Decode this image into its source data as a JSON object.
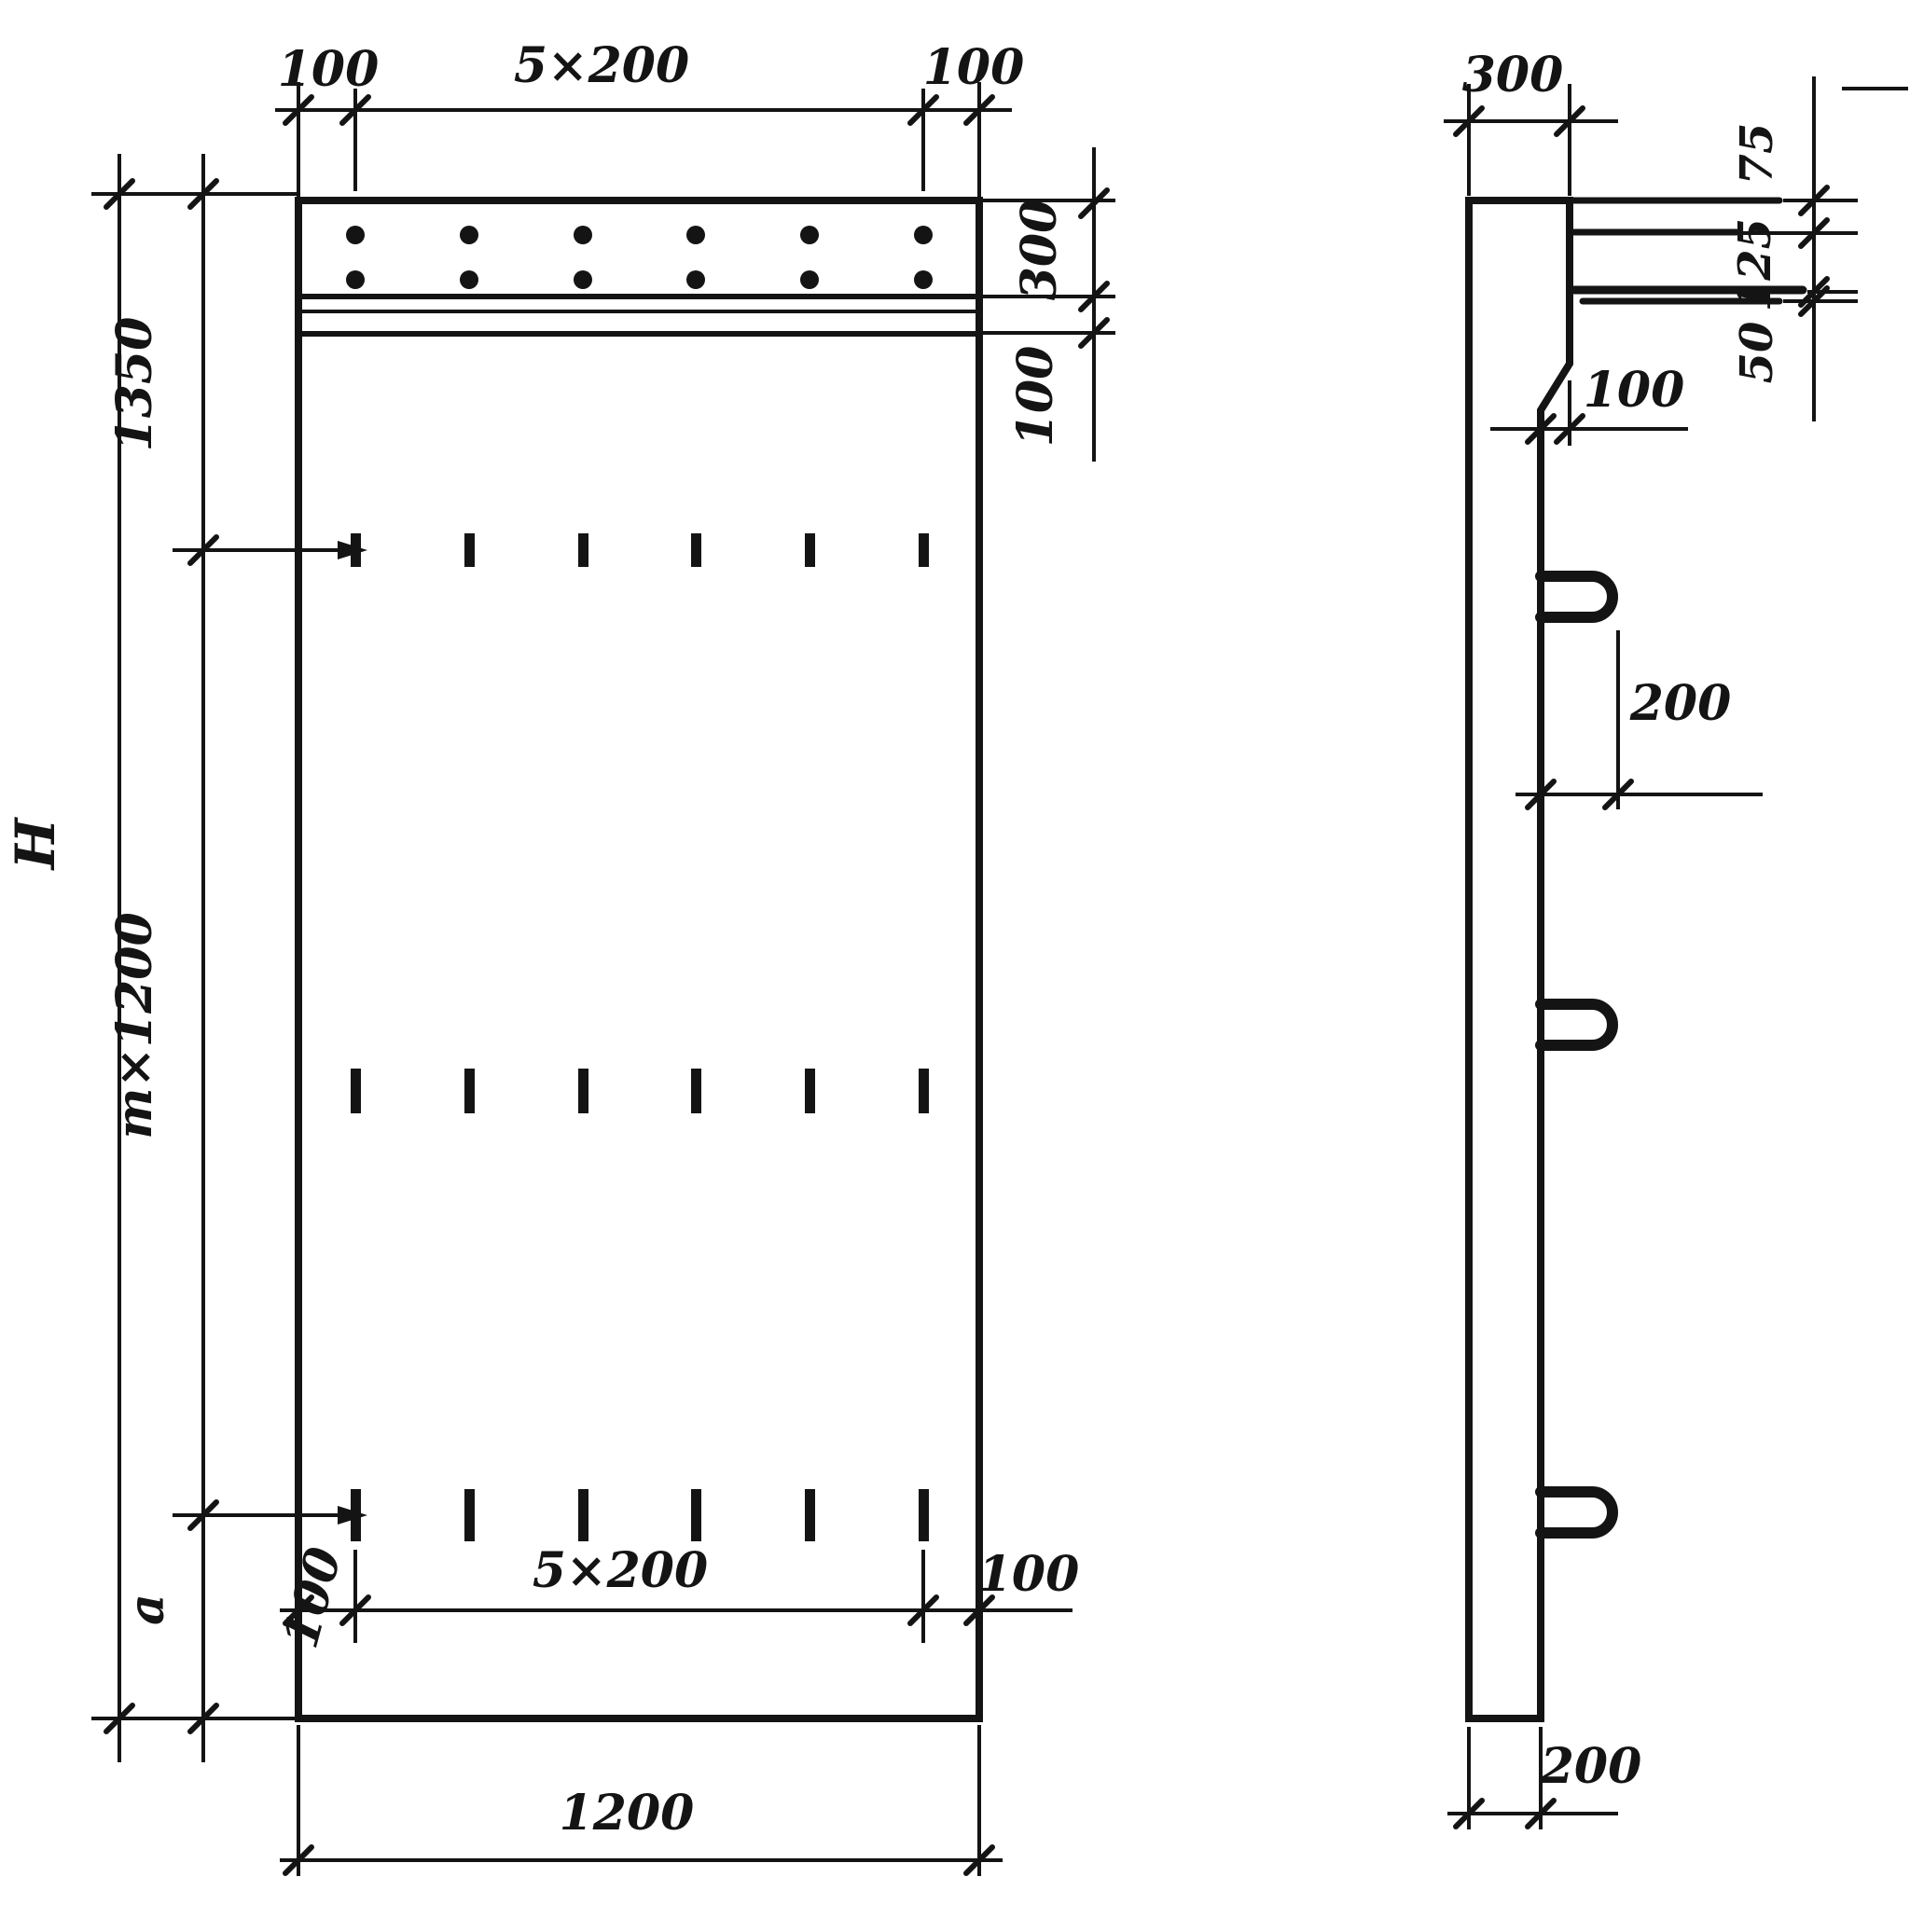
{
  "drawing": {
    "type": "reinforced concrete wall panel working drawing, front elevation and side section",
    "colors": {
      "ink": "#141414",
      "paper": "#ffffff"
    },
    "front_view": {
      "dim_top_left": "100",
      "dim_top_span": "5×200",
      "dim_top_right": "100",
      "dim_right_band": "300",
      "dim_right_gap": "100",
      "dim_left_total": "H",
      "dim_left_top": "1350",
      "dim_left_middle": "m×1200",
      "dim_left_bottom": "a",
      "dim_bottom_inner_left": "100",
      "dim_bottom_inner_span": "5×200",
      "dim_bottom_inner_right": "100",
      "dim_bottom_width": "1200"
    },
    "side_view": {
      "dim_top_width": "300",
      "dim_right_top": "75",
      "dim_right_middle": "125",
      "dim_right_bottom": "50",
      "dim_step": "100",
      "dim_loop_offset": "200",
      "dim_bottom_thickness": "200"
    }
  }
}
